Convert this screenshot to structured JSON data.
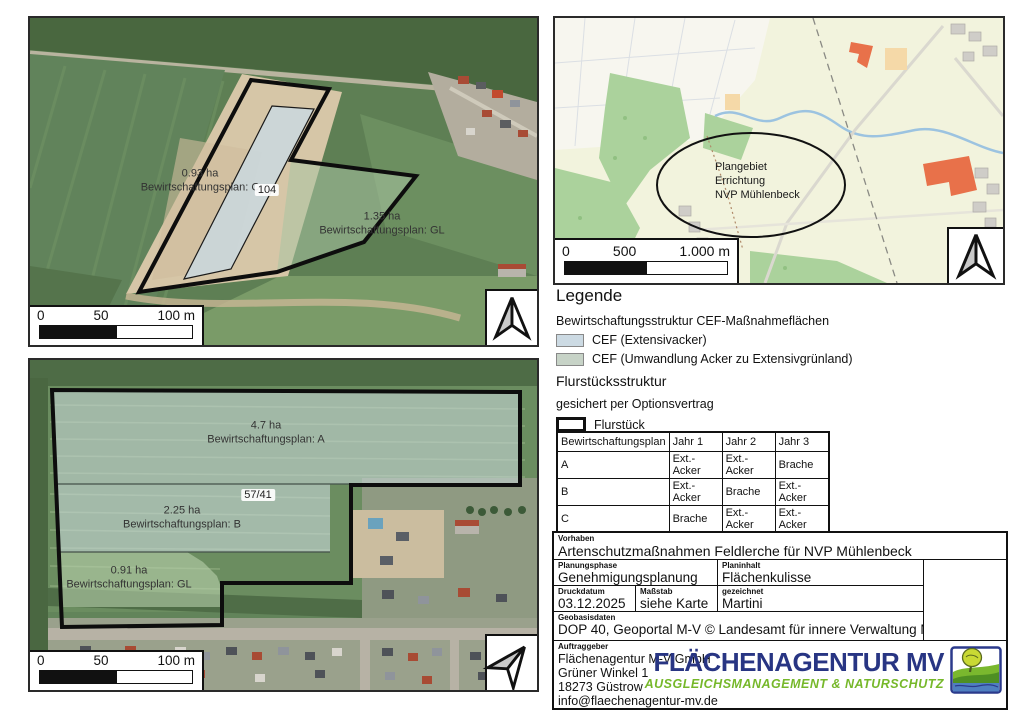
{
  "map_site_1": {
    "parcel_c_area": "0.93 ha",
    "parcel_c_plan": "Bewirtschaftungsplan: C",
    "flurstueck_no": "104",
    "parcel_gl_area": "1.35 ha",
    "parcel_gl_plan": "Bewirtschaftungsplan: GL",
    "scalebar": {
      "start": "0",
      "mid": "50",
      "end": "100 m"
    }
  },
  "map_site_2": {
    "parcel_a_area": "4.7 ha",
    "parcel_a_plan": "Bewirtschaftungsplan: A",
    "flurstueck_no": "57/41",
    "parcel_b_area": "2.25 ha",
    "parcel_b_plan": "Bewirtschaftungsplan: B",
    "parcel_gl_area": "0.91 ha",
    "parcel_gl_plan": "Bewirtschaftungsplan: GL",
    "scalebar": {
      "start": "0",
      "mid": "50",
      "end": "100 m"
    }
  },
  "map_overview": {
    "callout_line1": "Plangebiet",
    "callout_line2": "Errichtung",
    "callout_line3": "NVP Mühlenbeck",
    "scalebar": {
      "start": "0",
      "mid": "500",
      "end": "1.000 m"
    }
  },
  "legend": {
    "title": "Legende",
    "group1_title": "Bewirtschaftungsstruktur CEF-Maßnahmeflächen",
    "item1_label": "CEF (Extensivacker)",
    "item1_color": "#ccdae3",
    "item2_label": "CEF (Umwandlung Acker zu Extensivgrünland)",
    "item2_color": "#c7d3c7",
    "group2_title": "Flurstücksstruktur",
    "group2_note": "gesichert per Optionsvertrag",
    "item3_label": "Flurstück"
  },
  "plan_table": {
    "headers": [
      "Bewirtschaftungsplan",
      "Jahr 1",
      "Jahr 2",
      "Jahr 3"
    ],
    "rows": [
      [
        "A",
        "Ext.-Acker",
        "Ext.-Acker",
        "Brache"
      ],
      [
        "B",
        "Ext.-Acker",
        "Brache",
        "Ext.-Acker"
      ],
      [
        "C",
        "Brache",
        "Ext.-Acker",
        "Ext.-Acker"
      ],
      [
        "GL",
        "GL",
        "GL",
        "GL"
      ]
    ]
  },
  "titleblock": {
    "vorhaben_label": "Vorhaben",
    "vorhaben": "Artenschutzmaßnahmen Feldlerche für NVP Mühlenbeck",
    "planungsphase_label": "Planungsphase",
    "planungsphase": "Genehmigungsplanung",
    "planinhalt_label": "Planinhalt",
    "planinhalt": "Flächenkulisse",
    "druckdatum_label": "Druckdatum",
    "druckdatum": "03.12.2025",
    "massstab_label": "Maßstab",
    "massstab": "siehe Karte",
    "gezeichnet_label": "gezeichnet",
    "gezeichnet": "Martini",
    "geobasis_label": "Geobasisdaten",
    "geobasis": "DOP 40, Geoportal M-V © Landesamt für innere Verwaltung M-V",
    "auftraggeber_label": "Auftraggeber",
    "auftraggeber_line1": "Flächenagentur M-V GmbH",
    "auftraggeber_line2": "Grüner Winkel 1",
    "auftraggeber_line3": "18273 Güstrow",
    "auftraggeber_line4": "info@flaechenagentur-mv.de"
  },
  "logo": {
    "name_part1": "FLÄCHEN",
    "name_part2": "AGENTUR MV",
    "tagline": "AUSGLEICHSMANAGEMENT & NATURSCHUTZ",
    "color_navy": "#283583",
    "color_green": "#76b82a"
  }
}
